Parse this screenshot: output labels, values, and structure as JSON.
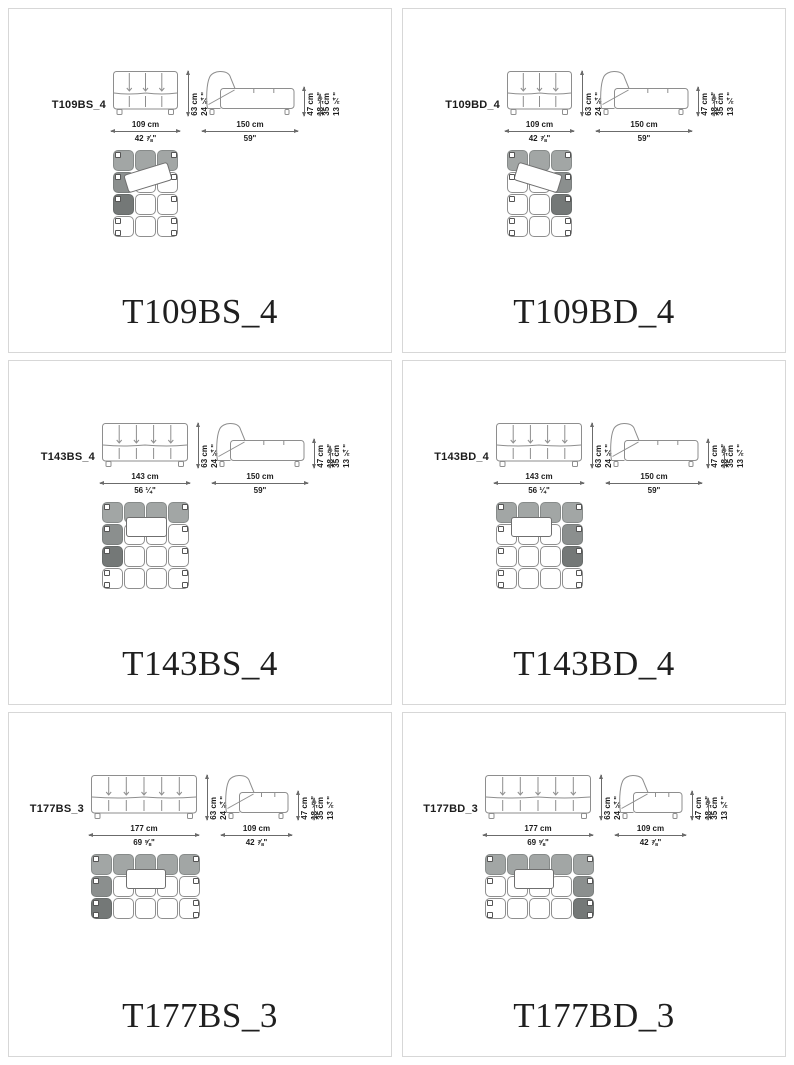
{
  "page": {
    "background": "#ffffff",
    "panel_border": "#d7d7d7"
  },
  "colors": {
    "shade_light": "#a2a6a5",
    "shade_medium": "#8b8f8e",
    "shade_dark": "#747877",
    "drawing_line": "#8e8e8e",
    "dimension_line": "#6b6b6b",
    "text": "#1c1c1c"
  },
  "panels": [
    {
      "code": "T109BS_4",
      "caption": "T109BS_4",
      "front": {
        "w_cm": "109 cm",
        "w_in": "42 ⅞\"",
        "h_cm": "63 cm",
        "h_in": "24 ¾\""
      },
      "side": {
        "w_cm": "150 cm",
        "w_in": "59\"",
        "h1_cm": "47 cm",
        "h1_in": "18 ½\"",
        "h2_cm": "35 cm",
        "h2_in": "13 ¾\""
      },
      "plan": {
        "cols": 3,
        "rows": 4,
        "medium": [
          [
            1,
            0
          ]
        ],
        "dark": [
          [
            2,
            0
          ]
        ],
        "cushion": {
          "cx": 35,
          "cy": 27,
          "w": 46,
          "h": 19,
          "rot": -17
        }
      }
    },
    {
      "code": "T109BD_4",
      "caption": "T109BD_4",
      "front": {
        "w_cm": "109 cm",
        "w_in": "42 ⅞\"",
        "h_cm": "63 cm",
        "h_in": "24 ¾\""
      },
      "side": {
        "w_cm": "150 cm",
        "w_in": "59\"",
        "h1_cm": "47 cm",
        "h1_in": "18 ½\"",
        "h2_cm": "35 cm",
        "h2_in": "13 ¾\""
      },
      "plan": {
        "cols": 3,
        "rows": 4,
        "medium": [
          [
            1,
            2
          ]
        ],
        "dark": [
          [
            2,
            2
          ]
        ],
        "cushion": {
          "cx": 31,
          "cy": 27,
          "w": 46,
          "h": 19,
          "rot": 17
        }
      }
    },
    {
      "code": "T143BS_4",
      "caption": "T143BS_4",
      "front": {
        "w_cm": "143 cm",
        "w_in": "56 ¼\"",
        "h_cm": "63 cm",
        "h_in": "24 ¾\""
      },
      "side": {
        "w_cm": "150 cm",
        "w_in": "59\"",
        "h1_cm": "47 cm",
        "h1_in": "18 ½\"",
        "h2_cm": "35 cm",
        "h2_in": "13 ¾\""
      },
      "plan": {
        "cols": 4,
        "rows": 4,
        "medium": [
          [
            1,
            0
          ]
        ],
        "dark": [
          [
            2,
            0
          ]
        ],
        "cushion": {
          "cx": 44,
          "cy": 25,
          "w": 41,
          "h": 20,
          "rot": 0
        }
      }
    },
    {
      "code": "T143BD_4",
      "caption": "T143BD_4",
      "front": {
        "w_cm": "143 cm",
        "w_in": "56 ¼\"",
        "h_cm": "63 cm",
        "h_in": "24 ¾\""
      },
      "side": {
        "w_cm": "150 cm",
        "w_in": "59\"",
        "h1_cm": "47 cm",
        "h1_in": "18 ½\"",
        "h2_cm": "35 cm",
        "h2_in": "13 ¾\""
      },
      "plan": {
        "cols": 4,
        "rows": 4,
        "medium": [
          [
            1,
            3
          ]
        ],
        "dark": [
          [
            2,
            3
          ]
        ],
        "cushion": {
          "cx": 35,
          "cy": 25,
          "w": 41,
          "h": 20,
          "rot": 0
        }
      }
    },
    {
      "code": "T177BS_3",
      "caption": "T177BS_3",
      "front": {
        "w_cm": "177 cm",
        "w_in": "69 ⅝\"",
        "h_cm": "63 cm",
        "h_in": "24 ¾\""
      },
      "side": {
        "w_cm": "109 cm",
        "w_in": "42 ⅞\"",
        "h1_cm": "47 cm",
        "h1_in": "18 ½\"",
        "h2_cm": "35 cm",
        "h2_in": "13 ¾\""
      },
      "plan": {
        "cols": 5,
        "rows": 3,
        "medium": [
          [
            1,
            0
          ]
        ],
        "dark": [
          [
            2,
            0
          ]
        ],
        "cushion": {
          "cx": 55,
          "cy": 25,
          "w": 40,
          "h": 20,
          "rot": 0
        }
      }
    },
    {
      "code": "T177BD_3",
      "caption": "T177BD_3",
      "front": {
        "w_cm": "177 cm",
        "w_in": "69 ⅝\"",
        "h_cm": "63 cm",
        "h_in": "24 ¾\""
      },
      "side": {
        "w_cm": "109 cm",
        "w_in": "42 ⅞\"",
        "h1_cm": "47 cm",
        "h1_in": "18 ½\"",
        "h2_cm": "35 cm",
        "h2_in": "13 ¾\""
      },
      "plan": {
        "cols": 5,
        "rows": 3,
        "medium": [
          [
            1,
            4
          ]
        ],
        "dark": [
          [
            2,
            4
          ]
        ],
        "cushion": {
          "cx": 49,
          "cy": 25,
          "w": 40,
          "h": 20,
          "rot": 0
        }
      }
    }
  ]
}
